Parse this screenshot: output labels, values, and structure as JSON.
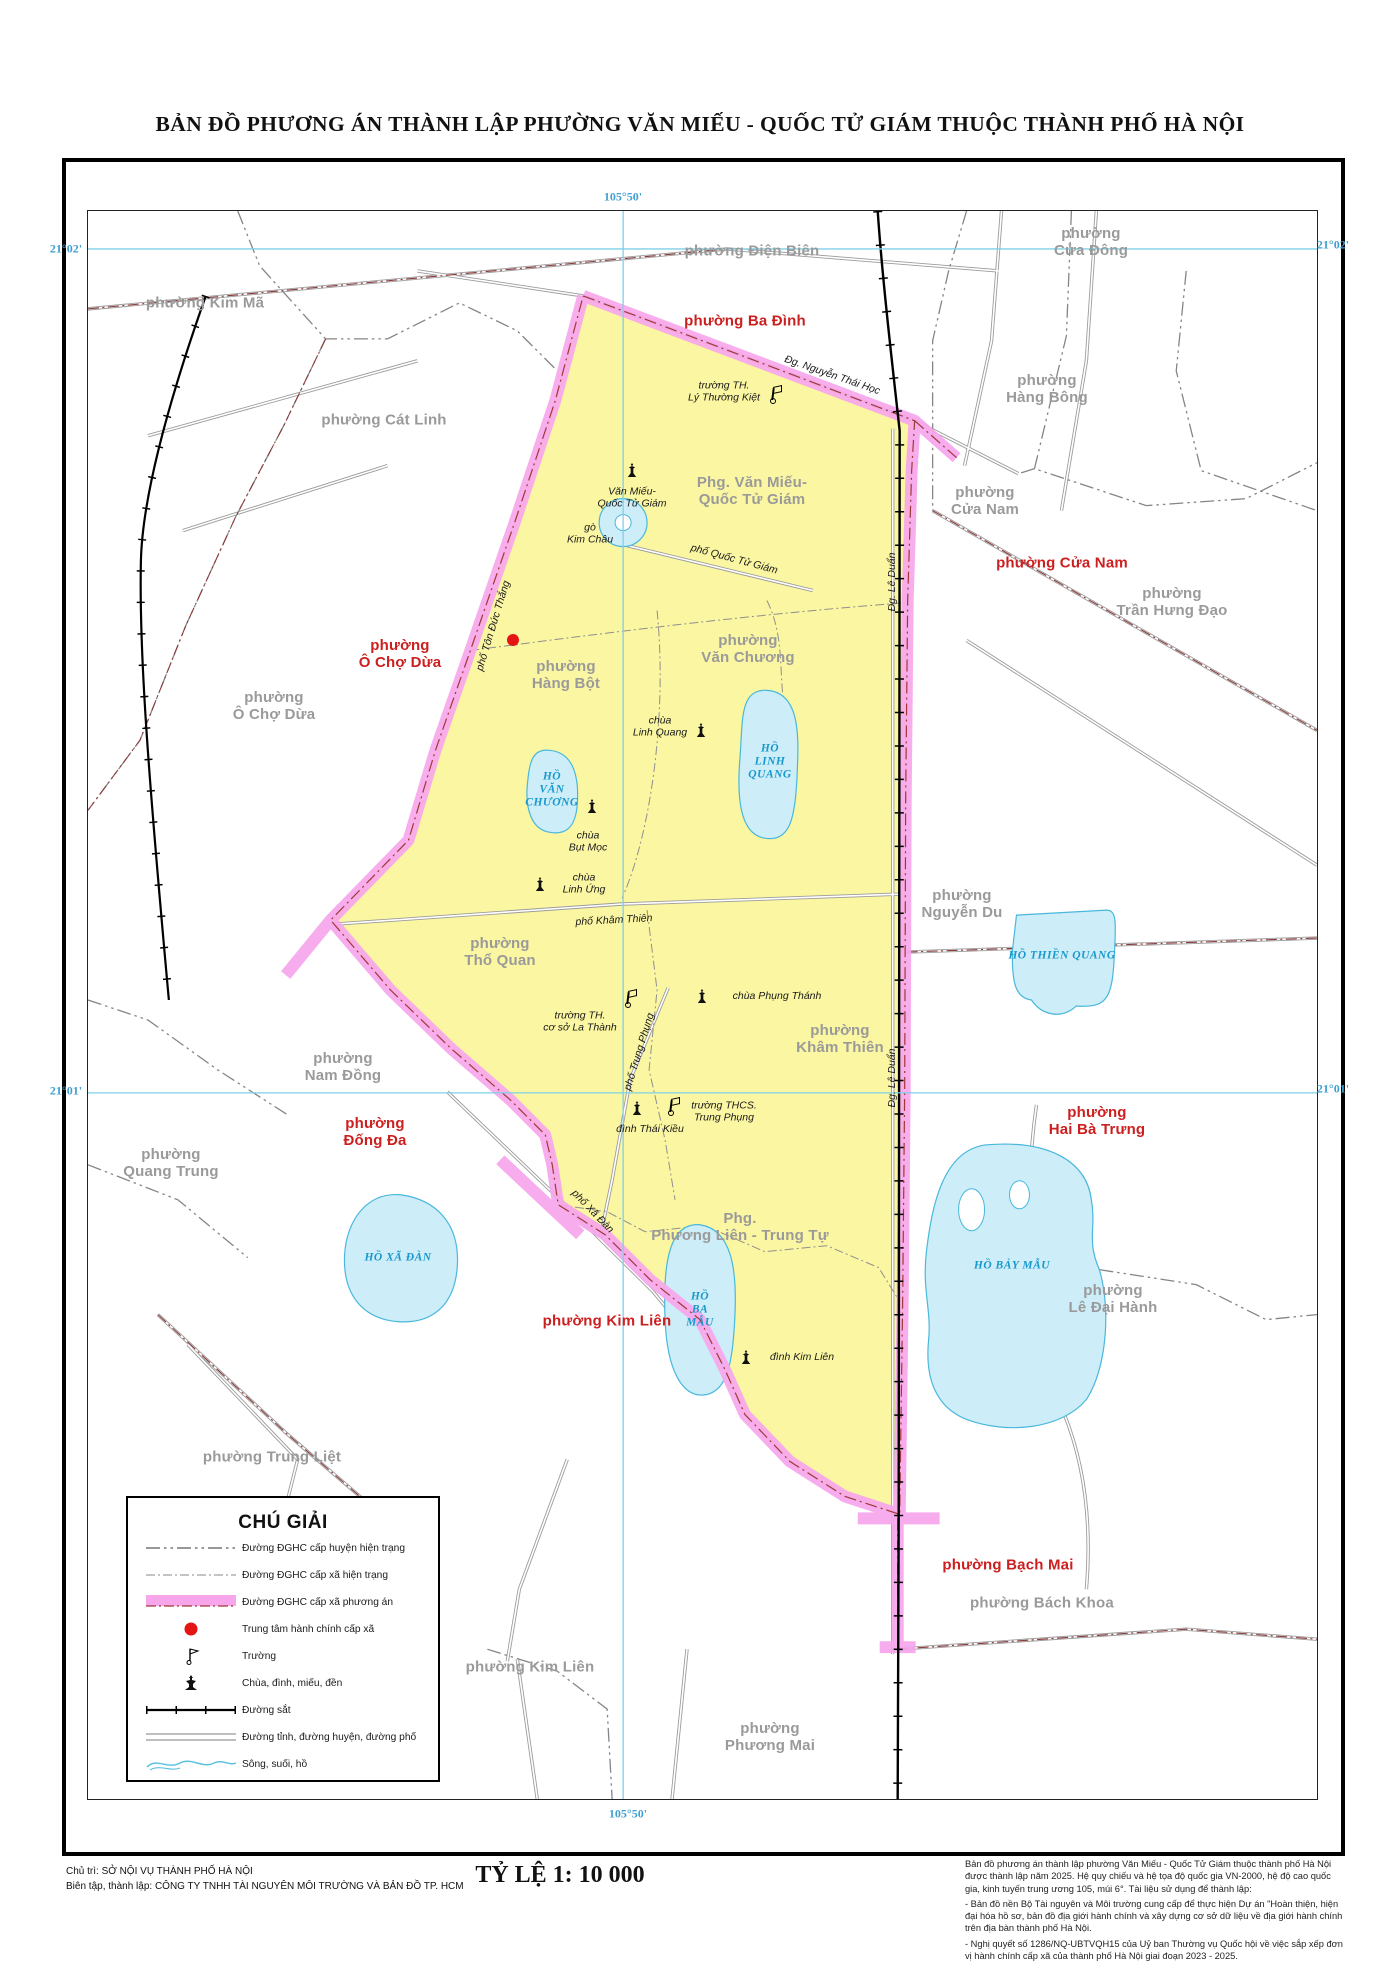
{
  "title": "BẢN ĐỒ  PHƯƠNG ÁN THÀNH LẬP PHƯỜNG VĂN MIẾU - QUỐC TỬ GIÁM THUỘC THÀNH PHỐ HÀ NỘI",
  "colors": {
    "ward_fill_yellow": "#FBF6A2",
    "boundary_band_pink": "#F7A6EC",
    "boundary_dash_red": "#A03838",
    "label_red": "#CC1F1F",
    "label_gray": "#9A9A9A",
    "lake_fill": "#CDEDF8",
    "lake_stroke": "#49B8DC",
    "lake_text": "#1898CC",
    "grid_blue": "#3F9FD0"
  },
  "map_labels": {
    "grid": [
      {
        "n": "grid-105-50-top",
        "t": [
          "105°50'"
        ],
        "x": 623,
        "y": 197
      },
      {
        "n": "grid-105-50-bottom",
        "t": [
          "105°50'"
        ],
        "x": 628,
        "y": 1814
      },
      {
        "n": "grid-21-02-left",
        "t": [
          "21°02'"
        ],
        "x": 66,
        "y": 249
      },
      {
        "n": "grid-21-02-right",
        "t": [
          "21°02'"
        ],
        "x": 1333,
        "y": 245
      },
      {
        "n": "grid-21-01-left",
        "t": [
          "21°01'"
        ],
        "x": 66,
        "y": 1091
      },
      {
        "n": "grid-21-01-right",
        "t": [
          "21°01'"
        ],
        "x": 1333,
        "y": 1089
      }
    ],
    "wards": [
      {
        "n": "ward-kim-ma",
        "t": [
          "phường Kim Mã"
        ],
        "x": 205,
        "y": 304
      },
      {
        "n": "ward-cat-linh",
        "t": [
          "phường Cát Linh"
        ],
        "x": 384,
        "y": 421
      },
      {
        "n": "ward-dien-bien",
        "t": [
          "phường Điện Biên"
        ],
        "x": 752,
        "y": 252
      },
      {
        "n": "ward-cua-dong",
        "t": [
          "phường",
          "Cửa Đông"
        ],
        "x": 1091,
        "y": 243
      },
      {
        "n": "ward-hang-bong",
        "t": [
          "phường",
          "Hàng Bông"
        ],
        "x": 1047,
        "y": 390
      },
      {
        "n": "ward-cua-nam-gray",
        "t": [
          "phường",
          "Cửa Nam"
        ],
        "x": 985,
        "y": 502
      },
      {
        "n": "ward-tran-hung-dao",
        "t": [
          "phường",
          "Trần Hưng Đạo"
        ],
        "x": 1172,
        "y": 603
      },
      {
        "n": "ward-o-cho-dua-gray",
        "t": [
          "phường",
          "Ô Chợ Dừa"
        ],
        "x": 274,
        "y": 707
      },
      {
        "n": "ward-nguyen-du",
        "t": [
          "phường",
          "Nguyễn Du"
        ],
        "x": 962,
        "y": 905
      },
      {
        "n": "ward-nam-dong",
        "t": [
          "phường",
          "Nam Đồng"
        ],
        "x": 343,
        "y": 1068
      },
      {
        "n": "ward-quang-trung",
        "t": [
          "phường",
          "Quang Trung"
        ],
        "x": 171,
        "y": 1164
      },
      {
        "n": "ward-trung-liet",
        "t": [
          "phường Trung Liệt"
        ],
        "x": 272,
        "y": 1458
      },
      {
        "n": "ward-kim-lien-gray",
        "t": [
          "phường Kim Liên"
        ],
        "x": 530,
        "y": 1668
      },
      {
        "n": "ward-phuong-mai",
        "t": [
          "phường",
          "Phương Mai"
        ],
        "x": 770,
        "y": 1738
      },
      {
        "n": "ward-bach-khoa",
        "t": [
          "phường Bách Khoa"
        ],
        "x": 1042,
        "y": 1604
      },
      {
        "n": "ward-le-dai-hanh",
        "t": [
          "phường",
          "Lê Đại Hành"
        ],
        "x": 1113,
        "y": 1300
      },
      {
        "n": "ward-ba-dinh",
        "t": [
          "phường Ba Đình"
        ],
        "x": 745,
        "y": 322,
        "c": "red"
      },
      {
        "n": "ward-cua-nam-red",
        "t": [
          "phường Cửa Nam"
        ],
        "x": 1062,
        "y": 564,
        "c": "red"
      },
      {
        "n": "ward-o-cho-dua-red",
        "t": [
          "phường",
          "Ô Chợ Dừa"
        ],
        "x": 400,
        "y": 655,
        "c": "red"
      },
      {
        "n": "ward-dong-da",
        "t": [
          "phường",
          "Đống Đa"
        ],
        "x": 375,
        "y": 1133,
        "c": "red"
      },
      {
        "n": "ward-hai-ba-trung",
        "t": [
          "phường",
          "Hai Bà Trưng"
        ],
        "x": 1097,
        "y": 1122,
        "c": "red"
      },
      {
        "n": "ward-kim-lien-red",
        "t": [
          "phường Kim Liên"
        ],
        "x": 607,
        "y": 1322,
        "c": "red"
      },
      {
        "n": "ward-bach-mai",
        "t": [
          "phường Bạch Mai"
        ],
        "x": 1008,
        "y": 1566,
        "c": "red"
      },
      {
        "n": "ward-van-mieu-qtg",
        "t": [
          "Phg. Văn Miếu-",
          "Quốc Tử Giám"
        ],
        "x": 752,
        "y": 492
      },
      {
        "n": "ward-hang-bot",
        "t": [
          "phường",
          "Hàng Bột"
        ],
        "x": 566,
        "y": 676
      },
      {
        "n": "ward-van-chuong",
        "t": [
          "phường",
          "Văn Chương"
        ],
        "x": 748,
        "y": 650
      },
      {
        "n": "ward-tho-quan",
        "t": [
          "phường",
          "Thổ Quan"
        ],
        "x": 500,
        "y": 953
      },
      {
        "n": "ward-kham-thien",
        "t": [
          "phường",
          "Khâm Thiên"
        ],
        "x": 840,
        "y": 1040
      },
      {
        "n": "ward-phuong-lien-trung-tu",
        "t": [
          "Phg.",
          "Phương Liên - Trung Tự"
        ],
        "x": 740,
        "y": 1228
      }
    ],
    "streets": [
      {
        "n": "street-nguyen-thai-hoc",
        "t": [
          "Đg. Nguyễn Thái Học"
        ],
        "x": 832,
        "y": 376,
        "r": 19
      },
      {
        "n": "street-le-duan-1",
        "t": [
          "Đg. Lê Duẩn"
        ],
        "x": 893,
        "y": 582,
        "r": -90
      },
      {
        "n": "street-le-duan-2",
        "t": [
          "Đg. Lê Duẩn"
        ],
        "x": 893,
        "y": 1078,
        "r": -90
      },
      {
        "n": "street-ton-duc-thang",
        "t": [
          "phố Tôn Đức Thắng"
        ],
        "x": 494,
        "y": 626,
        "r": -73
      },
      {
        "n": "street-quoc-tu-giam",
        "t": [
          "phố Quốc Tử Giám"
        ],
        "x": 734,
        "y": 560,
        "r": 15
      },
      {
        "n": "street-kham-thien",
        "t": [
          "phố Khâm Thiên"
        ],
        "x": 614,
        "y": 921,
        "r": -3
      },
      {
        "n": "street-trung-phung",
        "t": [
          "phố Trung Phụng"
        ],
        "x": 640,
        "y": 1052,
        "r": -73
      },
      {
        "n": "street-xa-dan",
        "t": [
          "phố Xã Đàn"
        ],
        "x": 592,
        "y": 1212,
        "r": 46
      }
    ],
    "pois": [
      {
        "n": "poi-van-mieu-label",
        "t": [
          "Văn Miếu-",
          "Quốc Tử Giám"
        ],
        "x": 632,
        "y": 498
      },
      {
        "n": "poi-go-kim-chau",
        "t": [
          "gò",
          "Kim Châu"
        ],
        "x": 590,
        "y": 534
      },
      {
        "n": "poi-chua-linh-quang",
        "t": [
          "chùa",
          "Linh Quang"
        ],
        "x": 660,
        "y": 727
      },
      {
        "n": "poi-chua-but-moc",
        "t": [
          "chùa",
          "Bụt Mọc"
        ],
        "x": 588,
        "y": 842
      },
      {
        "n": "poi-chua-linh-ung",
        "t": [
          "chùa",
          "Linh Ứng"
        ],
        "x": 584,
        "y": 884
      },
      {
        "n": "poi-chua-phung-thanh",
        "t": [
          "chùa Phụng Thánh"
        ],
        "x": 777,
        "y": 997
      },
      {
        "n": "poi-dinh-thai-kieu",
        "t": [
          "đình Thái Kiều"
        ],
        "x": 650,
        "y": 1130
      },
      {
        "n": "poi-dinh-kim-lien",
        "t": [
          "đình Kim Liên"
        ],
        "x": 802,
        "y": 1358
      },
      {
        "n": "poi-truong-ly-thuong-kiet",
        "t": [
          "trường TH.",
          "Lý Thường Kiệt"
        ],
        "x": 724,
        "y": 392
      },
      {
        "n": "poi-truong-la-thanh",
        "t": [
          "trường TH.",
          "cơ sở La Thành"
        ],
        "x": 580,
        "y": 1022
      },
      {
        "n": "poi-truong-trung-phung",
        "t": [
          "trường THCS.",
          "Trung Phụng"
        ],
        "x": 724,
        "y": 1112
      }
    ],
    "lakes": [
      {
        "n": "lake-linh-quang-label",
        "t": [
          "HỒ",
          "LINH",
          "QUANG"
        ],
        "x": 770,
        "y": 762
      },
      {
        "n": "lake-van-chuong-label",
        "t": [
          "HỒ",
          "VĂN",
          "CHƯƠNG"
        ],
        "x": 552,
        "y": 790
      },
      {
        "n": "lake-thien-quang-label",
        "t": [
          "HỒ THIỀN QUANG"
        ],
        "x": 1062,
        "y": 956
      },
      {
        "n": "lake-ba-mau-label",
        "t": [
          "HỒ",
          "BA",
          "MẪU"
        ],
        "x": 700,
        "y": 1310
      },
      {
        "n": "lake-bay-mau-label",
        "t": [
          "HỒ BẢY MẪU"
        ],
        "x": 1012,
        "y": 1266
      },
      {
        "n": "lake-xa-dan-label",
        "t": [
          "HỒ XÃ ĐÀN"
        ],
        "x": 398,
        "y": 1258
      }
    ]
  },
  "poi_icons": [
    {
      "n": "pagoda-icon-van-mieu",
      "k": "pagoda",
      "x": 632,
      "y": 470
    },
    {
      "n": "pagoda-icon-chua-linh-quang",
      "k": "pagoda",
      "x": 701,
      "y": 730
    },
    {
      "n": "pagoda-icon-chua-but-moc",
      "k": "pagoda",
      "x": 592,
      "y": 806
    },
    {
      "n": "pagoda-icon-chua-linh-ung",
      "k": "pagoda",
      "x": 540,
      "y": 884
    },
    {
      "n": "pagoda-icon-chua-phung-thanh",
      "k": "pagoda",
      "x": 702,
      "y": 996
    },
    {
      "n": "pagoda-icon-dinh-thai-kieu",
      "k": "pagoda",
      "x": 637,
      "y": 1108
    },
    {
      "n": "pagoda-icon-dinh-kim-lien",
      "k": "pagoda",
      "x": 746,
      "y": 1357
    },
    {
      "n": "school-flag-icon-ltk",
      "k": "flag",
      "x": 773,
      "y": 395
    },
    {
      "n": "school-flag-icon-la-thanh",
      "k": "flag",
      "x": 628,
      "y": 999
    },
    {
      "n": "school-flag-icon-trung-phung",
      "k": "flag",
      "x": 671,
      "y": 1107
    },
    {
      "n": "admin-center-dot",
      "k": "dot",
      "x": 513,
      "y": 640
    }
  ],
  "legend": {
    "title": "CHÚ GIẢI",
    "items": [
      {
        "sym": "line-district",
        "label": "Đường ĐGHC cấp huyện hiện trạng"
      },
      {
        "sym": "line-commune",
        "label": "Đường ĐGHC cấp xã hiện trạng"
      },
      {
        "sym": "band-plan",
        "label": "Đường ĐGHC cấp xã phương án"
      },
      {
        "sym": "dot-center",
        "label": "Trung tâm hành chính cấp xã"
      },
      {
        "sym": "flag-school",
        "label": "Trường"
      },
      {
        "sym": "pagoda",
        "label": "Chùa, đình, miếu, đền"
      },
      {
        "sym": "railway",
        "label": "Đường sắt"
      },
      {
        "sym": "road",
        "label": "Đường tỉnh, đường huyện, đường phố"
      },
      {
        "sym": "river",
        "label": "Sông, suối, hồ"
      }
    ]
  },
  "footer": {
    "credit_line_1": "Chủ trì:  SỞ NỘI VỤ THÀNH PHỐ HÀ NỘI",
    "credit_line_2": "Biên tập, thành lập:  CÔNG TY TNHH TÀI NGUYÊN MÔI TRƯỜNG VÀ BẢN ĐỒ TP. HCM",
    "scale_label": "TỶ LỆ 1: 10 000",
    "notes": [
      "Bản đồ phương án thành lập phường Văn Miếu - Quốc Tử Giám thuộc thành phố Hà Nội được thành lập năm 2025. Hệ quy chiếu và hệ tọa độ quốc gia VN-2000, hệ độ cao quốc gia, kinh tuyến trung ương 105, múi 6°. Tài liệu sử dụng để thành lập:",
      "- Bản đồ nền Bộ Tài nguyên và Môi trường cung cấp để thực hiện Dự án \"Hoàn thiện, hiện đại hóa hồ sơ, bản đồ địa giới hành chính và xây dựng cơ sở dữ liệu về địa giới hành chính trên địa bàn thành phố Hà Nội.",
      "- Nghị quyết số 1286/NQ-UBTVQH15 của Uỷ ban Thường vụ Quốc hội về việc sắp xếp đơn vị hành chính cấp xã của thành phố Hà Nội giai đoạn 2023 - 2025."
    ]
  }
}
